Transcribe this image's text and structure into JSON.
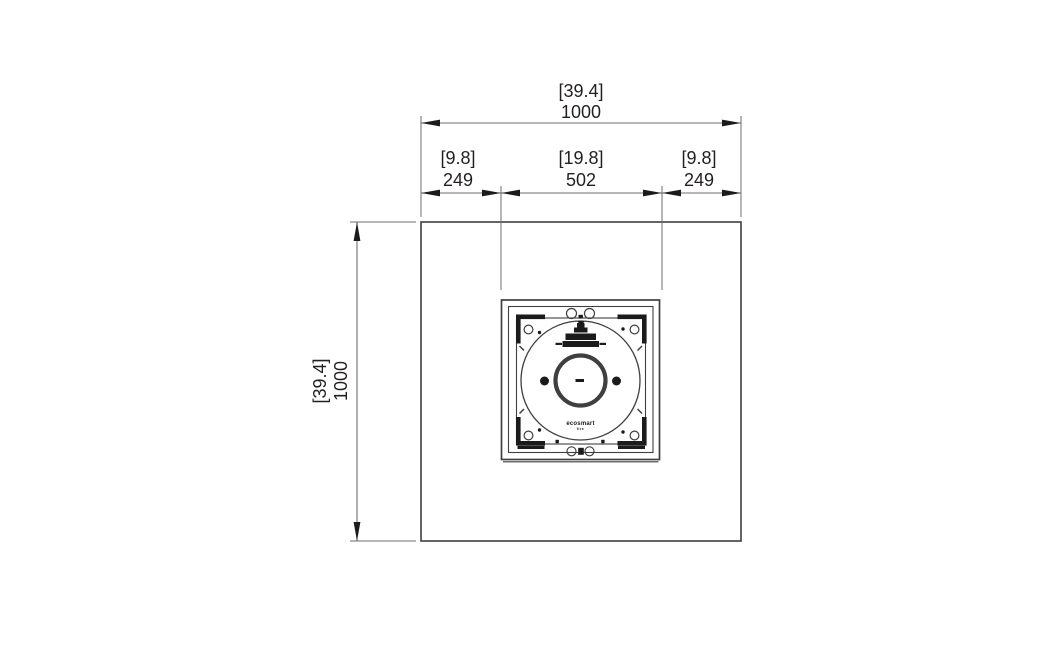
{
  "colors": {
    "background": "#ffffff",
    "object_line": "#3f3f3f",
    "dimension_line": "#6e6e6e",
    "ink": "#1b1b1b",
    "text": "#231f20"
  },
  "dimensions": {
    "overall_width": {
      "inches": "[39.4]",
      "mm": "1000"
    },
    "margin_left": {
      "inches": "[9.8]",
      "mm": "249"
    },
    "burner_width": {
      "inches": "[19.8]",
      "mm": "502"
    },
    "margin_right": {
      "inches": "[9.8]",
      "mm": "249"
    },
    "overall_height": {
      "inches": "[39.4]",
      "mm": "1000"
    }
  },
  "burner_logo": {
    "brand": "ecosmart",
    "sub": "fire"
  }
}
